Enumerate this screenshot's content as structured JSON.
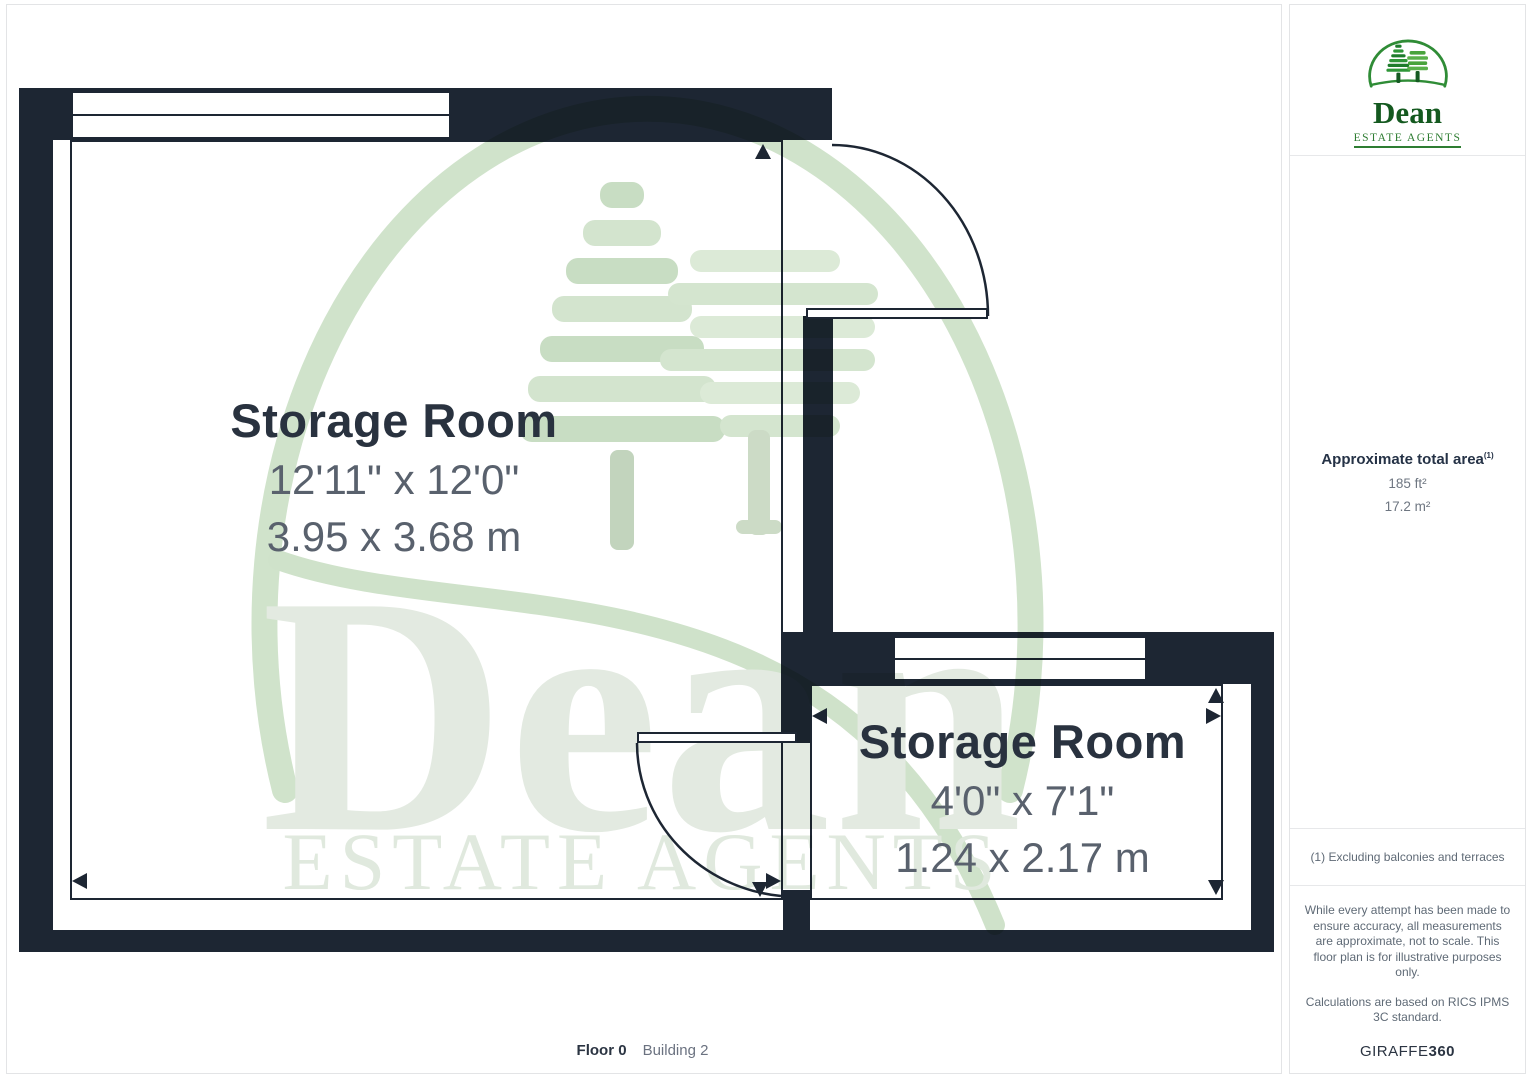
{
  "plan": {
    "rooms": [
      {
        "name": "Storage Room",
        "imperial": "12'11\" x 12'0\"",
        "metric": "3.95 x 3.68 m"
      },
      {
        "name": "Storage Room",
        "imperial": "4'0\" x 7'1\"",
        "metric": "1.24 x 2.17 m"
      }
    ],
    "floor_label": "Floor 0",
    "building_label": "Building 2",
    "watermark": {
      "title": "Dean",
      "subtitle": "ESTATE AGENTS"
    }
  },
  "sidebar": {
    "logo": {
      "name": "Dean",
      "tagline": "ESTATE AGENTS"
    },
    "area": {
      "heading": "Approximate total area",
      "superscript": "(1)",
      "imperial": "185 ft²",
      "metric": "17.2 m²"
    },
    "footnote": "(1) Excluding balconies and terraces",
    "disclaimer1": "While every attempt has been made to ensure accuracy, all measurements are approximate, not to scale. This floor plan is for illustrative purposes only.",
    "disclaimer2": "Calculations are based on RICS IPMS 3C standard.",
    "brand": {
      "giraffe": "GIRAFFE",
      "num": "360"
    }
  },
  "colors": {
    "wall": "#1d2633",
    "room_title": "#29323f",
    "room_dims": "#59616d",
    "logo_green_dark": "#14591f",
    "logo_green": "#2e7d32",
    "watermark_green": "#d0e3cb"
  }
}
